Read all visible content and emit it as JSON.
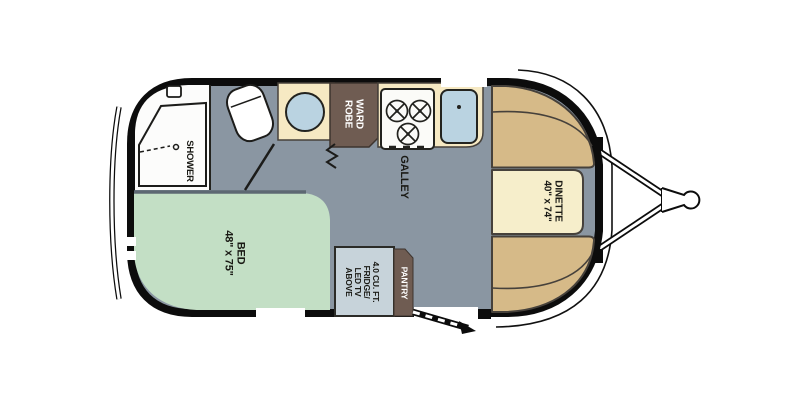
{
  "floorplan": {
    "shower": {
      "label": "SHOWER"
    },
    "wardrobe": {
      "line1": "WARD",
      "line2": "ROBE"
    },
    "galley": {
      "label": "GALLEY"
    },
    "dinette": {
      "name": "DINETTE",
      "size": "40\" x 74\""
    },
    "bed": {
      "name": "BED",
      "size": "48\" x 75\""
    },
    "pantry": {
      "label": "PANTRY"
    },
    "fridge": {
      "line1": "4.0 CU. FT.",
      "line2": "FRIDGE/",
      "line3": "LED TV",
      "line4": "ABOVE"
    },
    "colors": {
      "floor": "#8a96a2",
      "bathroom": "#fcfcfb",
      "bed": "#c3dfc5",
      "bed_wall": "#5d6873",
      "dinette_cushion": "#d6ba88",
      "dinette_table": "#f6eecb",
      "counter": "#f6e9c3",
      "wood": "#6f5c52",
      "fridge": "#c7d3da",
      "sink": "#bad3e1",
      "cooktop": "#fbfbf8",
      "outline": "#0c0c0c"
    }
  }
}
